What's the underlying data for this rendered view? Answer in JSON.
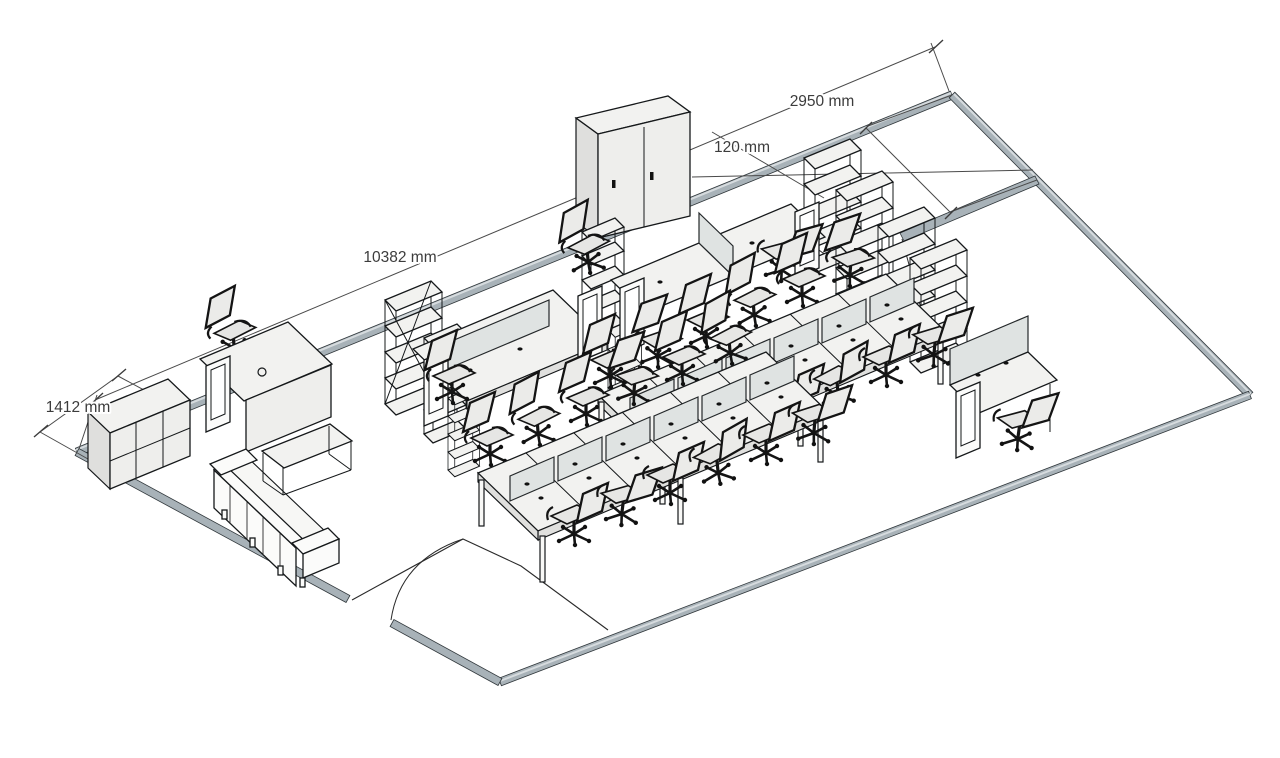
{
  "scene": {
    "title": "Office floor plan - isometric 3D line drawing",
    "style": "sketchup-style-render",
    "background": "#ffffff"
  },
  "annotations": {
    "dim_corner_room_wall": "2950 mm",
    "dim_partition_thickness": "120 mm",
    "dim_main_wall_length": "10382 mm",
    "dim_sideboard_width": "1412 mm"
  },
  "colors": {
    "wall_fill": "#a8b2b8",
    "wall_highlight": "#d6dbde",
    "outline": "#15181a",
    "dimension_line": "#4a4a4a",
    "dimension_text": "#3c3c3c",
    "surface_top": "#f2f2f0",
    "surface_front": "#eeeeec",
    "privacy_screen": "#dfe3e2",
    "chair_frame": "#141414",
    "chair_panel": "#e9e9e7"
  },
  "furniture": {
    "wardrobe_cabinets": 1,
    "tall_bookshelf_columns": 4,
    "braced_shelf_racks": 1,
    "small_shelf_towers": 4,
    "bench_workstation_rows": 2,
    "workstation_seats": 24,
    "standalone_desks": 5,
    "office_chairs": 29,
    "sofas": 1,
    "coffee_tables": 1,
    "sideboards": 1,
    "door_swings": 2
  }
}
